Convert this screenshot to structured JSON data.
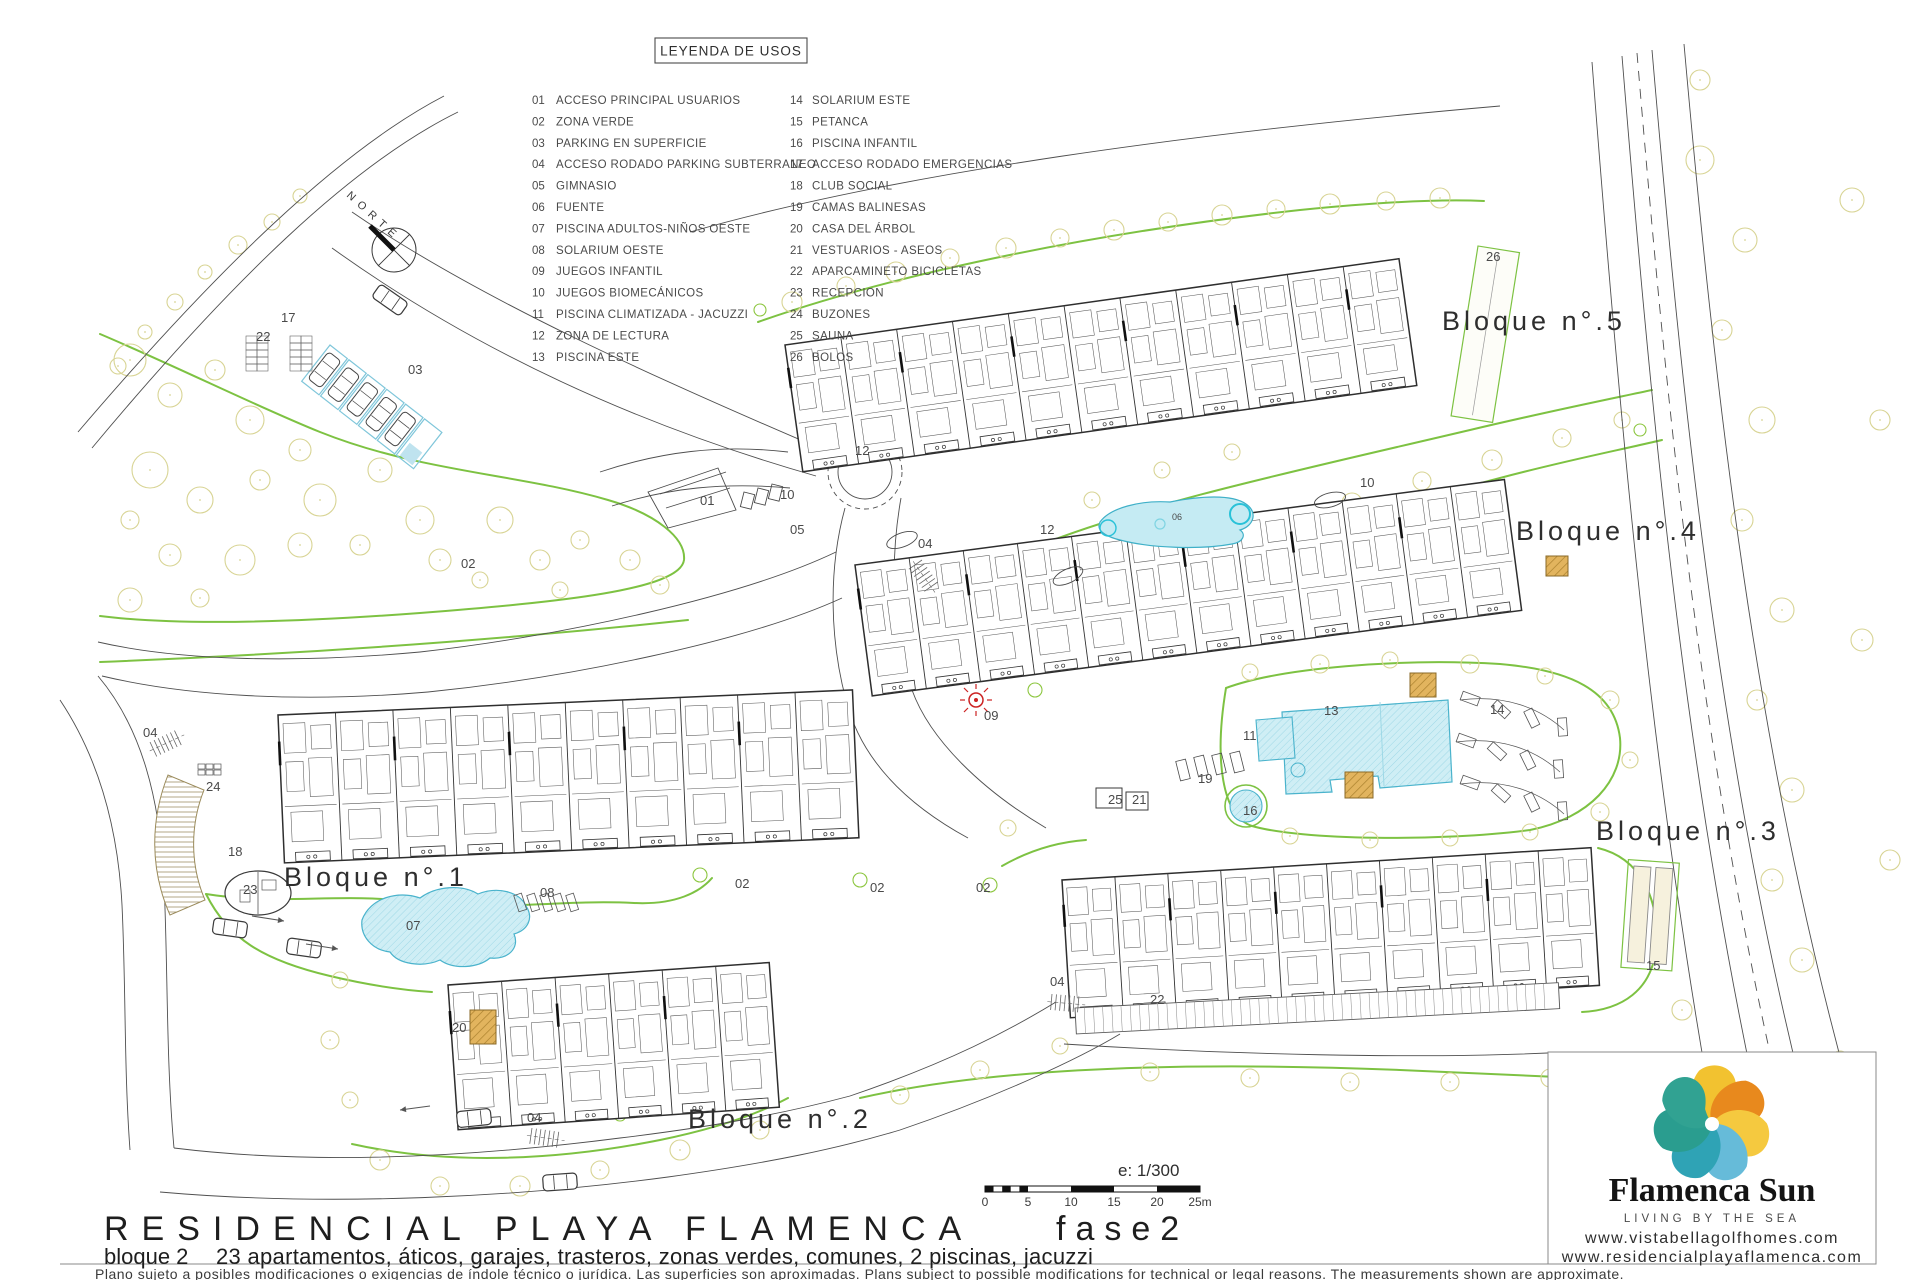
{
  "legend": {
    "title": "LEYENDA DE USOS",
    "items": [
      {
        "n": "01",
        "label": "ACCESO PRINCIPAL USUARIOS"
      },
      {
        "n": "02",
        "label": "ZONA VERDE"
      },
      {
        "n": "03",
        "label": "PARKING EN SUPERFICIE"
      },
      {
        "n": "04",
        "label": "ACCESO RODADO PARKING SUBTERRANEO"
      },
      {
        "n": "05",
        "label": "GIMNASIO"
      },
      {
        "n": "06",
        "label": "FUENTE"
      },
      {
        "n": "07",
        "label": "PISCINA ADULTOS-NIÑOS OESTE"
      },
      {
        "n": "08",
        "label": "SOLARIUM OESTE"
      },
      {
        "n": "09",
        "label": "JUEGOS INFANTIL"
      },
      {
        "n": "10",
        "label": "JUEGOS BIOMECÁNICOS"
      },
      {
        "n": "11",
        "label": "PISCINA CLIMATIZADA - JACUZZI"
      },
      {
        "n": "12",
        "label": "ZONA DE LECTURA"
      },
      {
        "n": "13",
        "label": "PISCINA ESTE"
      },
      {
        "n": "14",
        "label": "SOLARIUM ESTE"
      },
      {
        "n": "15",
        "label": "PETANCA"
      },
      {
        "n": "16",
        "label": "PISCINA INFANTIL"
      },
      {
        "n": "17",
        "label": "ACCESO RODADO EMERGENCIAS"
      },
      {
        "n": "18",
        "label": "CLUB SOCIAL"
      },
      {
        "n": "19",
        "label": "CAMAS BALINESAS"
      },
      {
        "n": "20",
        "label": "CASA DEL ÁRBOL"
      },
      {
        "n": "21",
        "label": "VESTUARIOS - ASEOS"
      },
      {
        "n": "22",
        "label": "APARCAMINETO BICICLETAS"
      },
      {
        "n": "23",
        "label": "RECEPCION"
      },
      {
        "n": "24",
        "label": "BUZONES"
      },
      {
        "n": "25",
        "label": "SAUNA"
      },
      {
        "n": "26",
        "label": "BOLOS"
      }
    ]
  },
  "north": {
    "label": "NORTE"
  },
  "bloques": [
    {
      "label": "Bloque n°.1",
      "x": 284,
      "y": 886
    },
    {
      "label": "Bloque n°.2",
      "x": 688,
      "y": 1128
    },
    {
      "label": "Bloque n°.3",
      "x": 1596,
      "y": 840
    },
    {
      "label": "Bloque n°.4",
      "x": 1516,
      "y": 540
    },
    {
      "label": "Bloque n°.5",
      "x": 1442,
      "y": 330
    }
  ],
  "plan_labels": [
    {
      "t": "17",
      "x": 281,
      "y": 322
    },
    {
      "t": "22",
      "x": 256,
      "y": 341
    },
    {
      "t": "03",
      "x": 408,
      "y": 374
    },
    {
      "t": "01",
      "x": 700,
      "y": 505
    },
    {
      "t": "05",
      "x": 790,
      "y": 534
    },
    {
      "t": "04",
      "x": 918,
      "y": 548
    },
    {
      "t": "04",
      "x": 143,
      "y": 737
    },
    {
      "t": "04",
      "x": 527,
      "y": 1122
    },
    {
      "t": "04",
      "x": 1050,
      "y": 986
    },
    {
      "t": "02",
      "x": 461,
      "y": 568
    },
    {
      "t": "02",
      "x": 735,
      "y": 888
    },
    {
      "t": "02",
      "x": 870,
      "y": 892
    },
    {
      "t": "02",
      "x": 976,
      "y": 892
    },
    {
      "t": "09",
      "x": 984,
      "y": 720
    },
    {
      "t": "12",
      "x": 1040,
      "y": 534
    },
    {
      "t": "12",
      "x": 855,
      "y": 455
    },
    {
      "t": "10",
      "x": 1360,
      "y": 487
    },
    {
      "t": "10",
      "x": 780,
      "y": 499
    },
    {
      "t": "06",
      "x": 1172,
      "y": 520,
      "s": 9
    },
    {
      "t": "11",
      "x": 1243,
      "y": 740
    },
    {
      "t": "13",
      "x": 1324,
      "y": 715
    },
    {
      "t": "14",
      "x": 1490,
      "y": 714
    },
    {
      "t": "16",
      "x": 1243,
      "y": 815
    },
    {
      "t": "19",
      "x": 1198,
      "y": 783
    },
    {
      "t": "25",
      "x": 1108,
      "y": 804
    },
    {
      "t": "21",
      "x": 1132,
      "y": 804
    },
    {
      "t": "18",
      "x": 228,
      "y": 856
    },
    {
      "t": "23",
      "x": 243,
      "y": 894
    },
    {
      "t": "24",
      "x": 206,
      "y": 791
    },
    {
      "t": "20",
      "x": 452,
      "y": 1032
    },
    {
      "t": "22",
      "x": 1150,
      "y": 1004
    },
    {
      "t": "15",
      "x": 1646,
      "y": 970
    },
    {
      "t": "26",
      "x": 1486,
      "y": 261
    },
    {
      "t": "07",
      "x": 406,
      "y": 930
    },
    {
      "t": "08",
      "x": 540,
      "y": 897
    }
  ],
  "scalebar": {
    "label": "e: 1/300",
    "ticks": [
      "0",
      "5",
      "10",
      "15",
      "20",
      "25m"
    ]
  },
  "title_block": {
    "project": "RESIDENCIAL PLAYA FLAMENCA",
    "phase": "fase2",
    "subtitle_left": "bloque 2",
    "subtitle_right": "23 apartamentos, áticos, garajes, trasteros, zonas verdes, comunes, 2 piscinas, jacuzzi",
    "disclaimer": "Plano sujeto a posibles modificaciones o exigencias de índole técnico o jurídica. Las superficies son aproximadas. Plans subject to possible modifications for technical or legal reasons. The measurements shown are approximate."
  },
  "brand": {
    "name": "Flamenca Sun",
    "tagline": "LIVING BY THE SEA",
    "url1": "www.vistabellagolfhomes.com",
    "url2": "www.residencialplayaflamenca.com"
  },
  "colors": {
    "green": "#7dc242",
    "tree": "#d8d494",
    "water_fill": "#cfeef5",
    "water_stroke": "#4ab3cc",
    "tan": "#e2b45e",
    "logo_orange": "#e8891d",
    "logo_yellow": "#f2c230",
    "logo_lightblue": "#66bbd9",
    "logo_teal": "#2a9d8f"
  }
}
